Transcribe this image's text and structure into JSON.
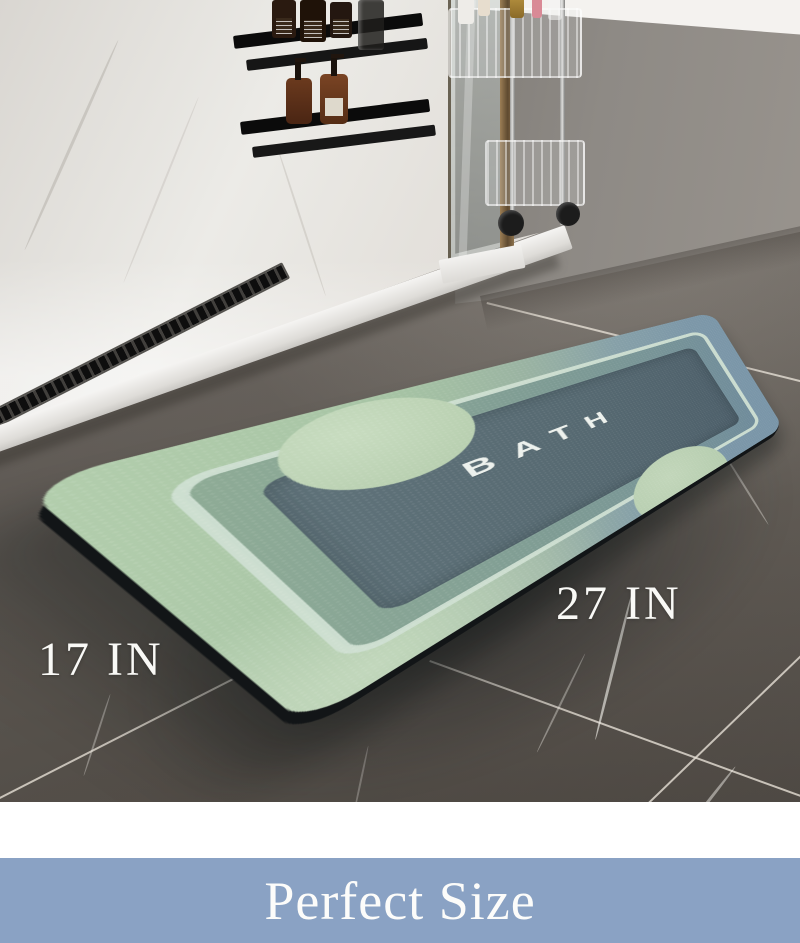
{
  "photo": {
    "mat_print_text": "BATH",
    "dimension_labels": {
      "width": "17 IN",
      "length": "27 IN"
    }
  },
  "banner": {
    "text": "Perfect Size",
    "background_color": "#8AA2C4",
    "text_color": "#FCFCFA"
  },
  "mat_colors": {
    "border_green": "#A6C3A4",
    "border_slate": "#7C95A6",
    "stripe_mint": "#CFDFD2",
    "mid_band_green": "#8FAC96",
    "mid_band_slate": "#6F8B9B",
    "field_dark": "#54666F",
    "accent_sage": "#BCD2B4",
    "edge_black": "#14171A"
  },
  "scene_colors": {
    "floor_tile_gray": "#6E6862",
    "wall_gray": "#8E8A85",
    "upper_wall_white": "#F4F2EF",
    "shower_marble": "#ECEBE7",
    "door_frame_bronze": "#8C714C"
  }
}
